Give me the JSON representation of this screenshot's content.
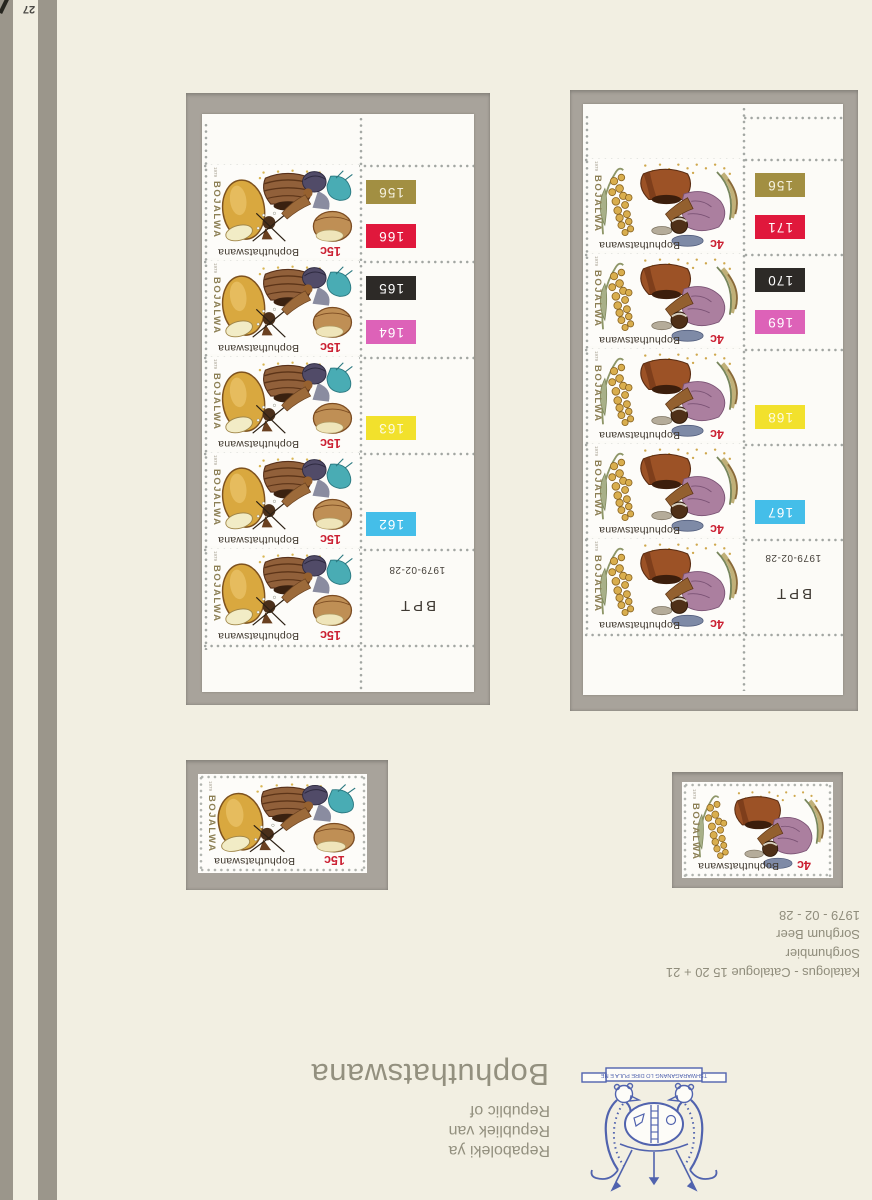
{
  "page": {
    "number": "27"
  },
  "colors": {
    "page_bg": "#f2efe2",
    "stripe": "#9b968b",
    "mount": "#a8a39b",
    "sheet": "#fcfbf7",
    "value_red": "#cb2133",
    "caption_gray": "#93907f",
    "emblem_blue": "#5163ae"
  },
  "stamps": {
    "s15": {
      "bojalwa": "BOJALWA",
      "country": "Bophuthatswana",
      "value": "15c",
      "year": "1979"
    },
    "s4": {
      "bojalwa": "BOJALWA",
      "country": "Bophuthatswana",
      "value": "4c",
      "year": "1979"
    }
  },
  "blocks": [
    {
      "name": "control-block-15c",
      "stamp_ref": "s15",
      "count": 5,
      "margin": {
        "date": "1979-02-28",
        "printer": "BPT",
        "chips": [
          {
            "label": "156",
            "color": "#a28f42",
            "text": "#f5f2e0",
            "row": 0,
            "slot": "upper"
          },
          {
            "label": "166",
            "color": "#e0183c",
            "text": "#ffffff",
            "row": 0,
            "slot": "lower"
          },
          {
            "label": "165",
            "color": "#2d2a27",
            "text": "#ffffff",
            "row": 1,
            "slot": "upper"
          },
          {
            "label": "164",
            "color": "#dd62b8",
            "text": "#ffffff",
            "row": 1,
            "slot": "lower"
          },
          {
            "label": "163",
            "color": "#f2e12c",
            "text": "#fdfbe0",
            "row": 2,
            "slot": "lower"
          },
          {
            "label": "162",
            "color": "#44bee9",
            "text": "#ffffff",
            "row": 3,
            "slot": "lower"
          }
        ]
      }
    },
    {
      "name": "control-block-4c",
      "stamp_ref": "s4",
      "count": 5,
      "margin": {
        "date": "1979-02-28",
        "printer": "BPT",
        "chips": [
          {
            "label": "156",
            "color": "#a28f42",
            "text": "#f5f2e0",
            "row": 0,
            "slot": "upper"
          },
          {
            "label": "171",
            "color": "#e0183c",
            "text": "#ffffff",
            "row": 0,
            "slot": "lower"
          },
          {
            "label": "170",
            "color": "#2d2a27",
            "text": "#ffffff",
            "row": 1,
            "slot": "upper"
          },
          {
            "label": "169",
            "color": "#dd62b8",
            "text": "#ffffff",
            "row": 1,
            "slot": "lower"
          },
          {
            "label": "168",
            "color": "#f2e12c",
            "text": "#fdfbe0",
            "row": 2,
            "slot": "lower"
          },
          {
            "label": "167",
            "color": "#44bee9",
            "text": "#ffffff",
            "row": 3,
            "slot": "lower"
          }
        ]
      }
    }
  ],
  "singles": [
    {
      "name": "single-stamp-15c",
      "stamp_ref": "s15"
    },
    {
      "name": "single-stamp-4c",
      "stamp_ref": "s4"
    }
  ],
  "captions": {
    "catalog_lines": [
      "Katalogus - Catalogue 15 20 + 21",
      "Sorghumbier",
      "Sorghum Beer",
      "1979 - 02 - 28"
    ],
    "country_large": "Bophuthatswana",
    "republic_lines": [
      "Repaboleki ya",
      "Republiek van",
      "Republic of"
    ],
    "motto": "TSHWARAGANANG LO DIRE PULA E NE"
  }
}
